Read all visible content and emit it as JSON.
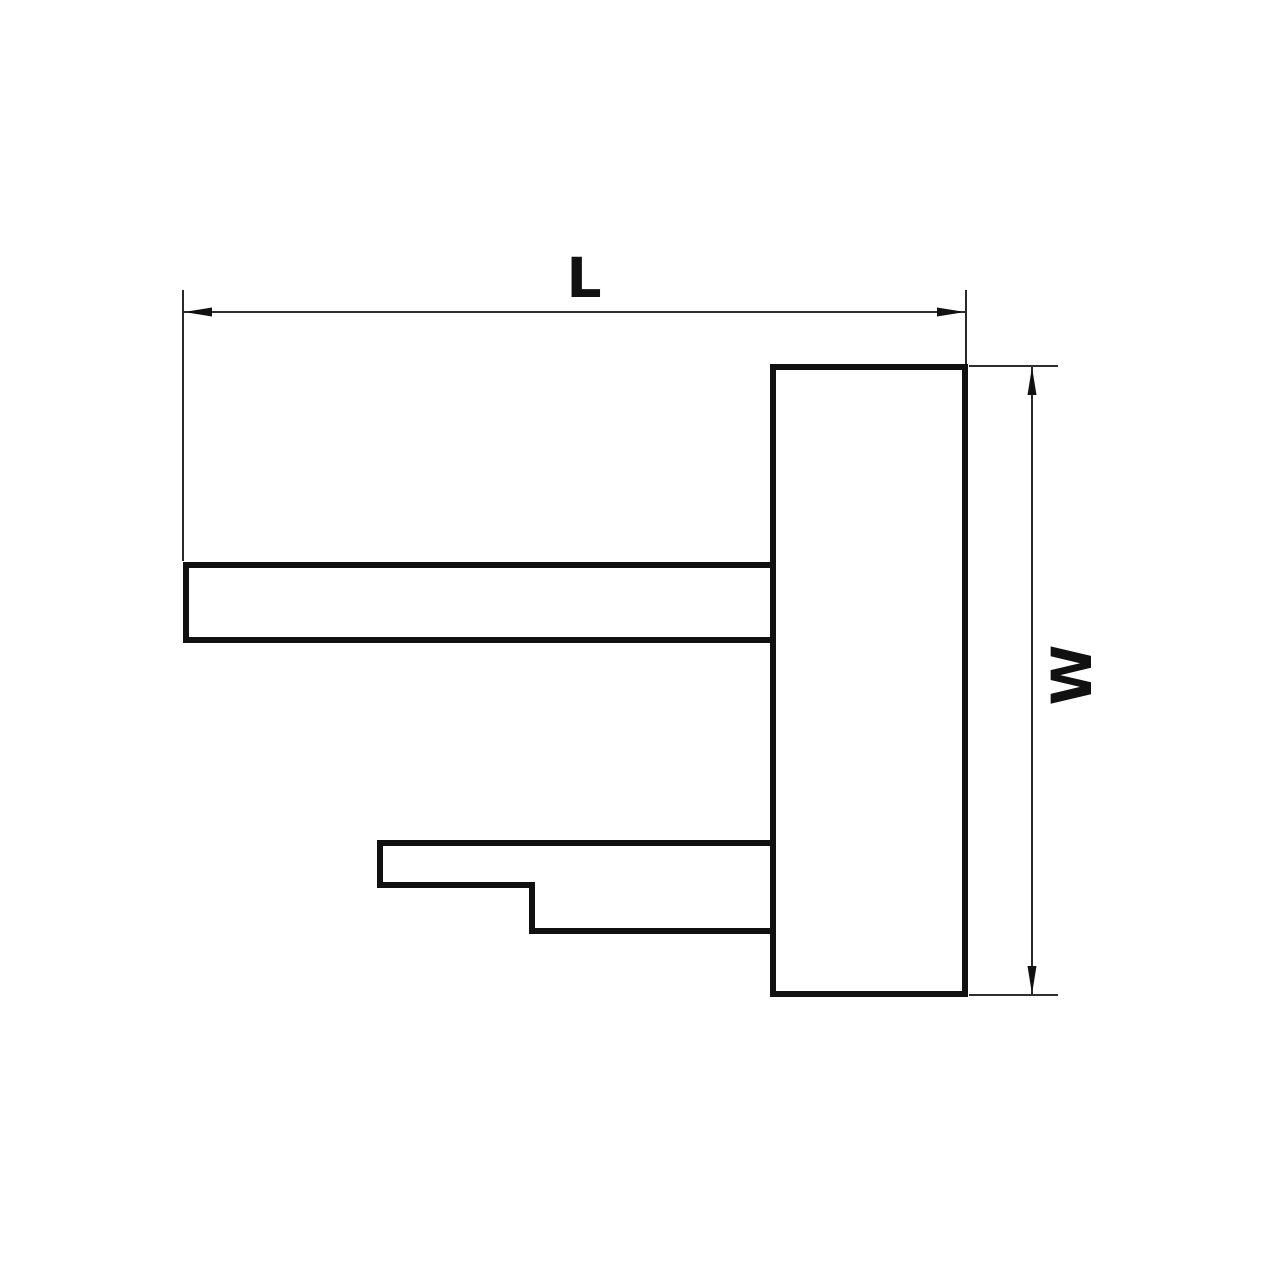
{
  "diagram": {
    "type": "technical-drawing",
    "dimensions": [
      {
        "id": "length",
        "label": "L",
        "orientation": "horizontal"
      },
      {
        "id": "width",
        "label": "W",
        "orientation": "vertical"
      }
    ],
    "colors": {
      "line": "#111111",
      "background": "#ffffff"
    }
  }
}
